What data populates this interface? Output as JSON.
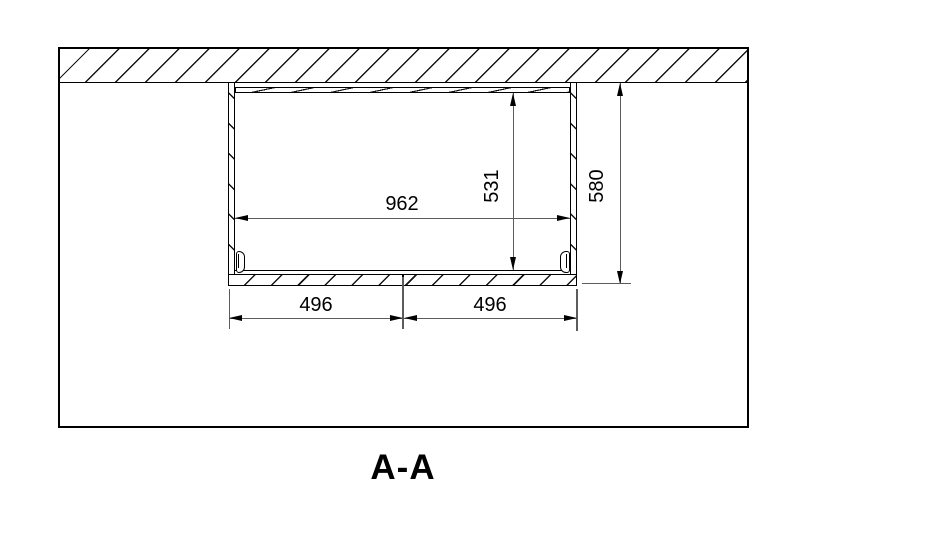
{
  "view": {
    "label": "A-A"
  },
  "dimensions": [
    {
      "name": "interior-width",
      "value": "962",
      "orientation": "horizontal"
    },
    {
      "name": "interior-height",
      "value": "531",
      "orientation": "vertical"
    },
    {
      "name": "overall-height",
      "value": "580",
      "orientation": "vertical"
    },
    {
      "name": "bottom-left-width",
      "value": "496",
      "orientation": "horizontal"
    },
    {
      "name": "bottom-right-width",
      "value": "496",
      "orientation": "horizontal"
    }
  ],
  "colors": {
    "line": "#000000",
    "dimension_line": "#5c5c5c",
    "text": "#000000",
    "background": "#ffffff"
  }
}
